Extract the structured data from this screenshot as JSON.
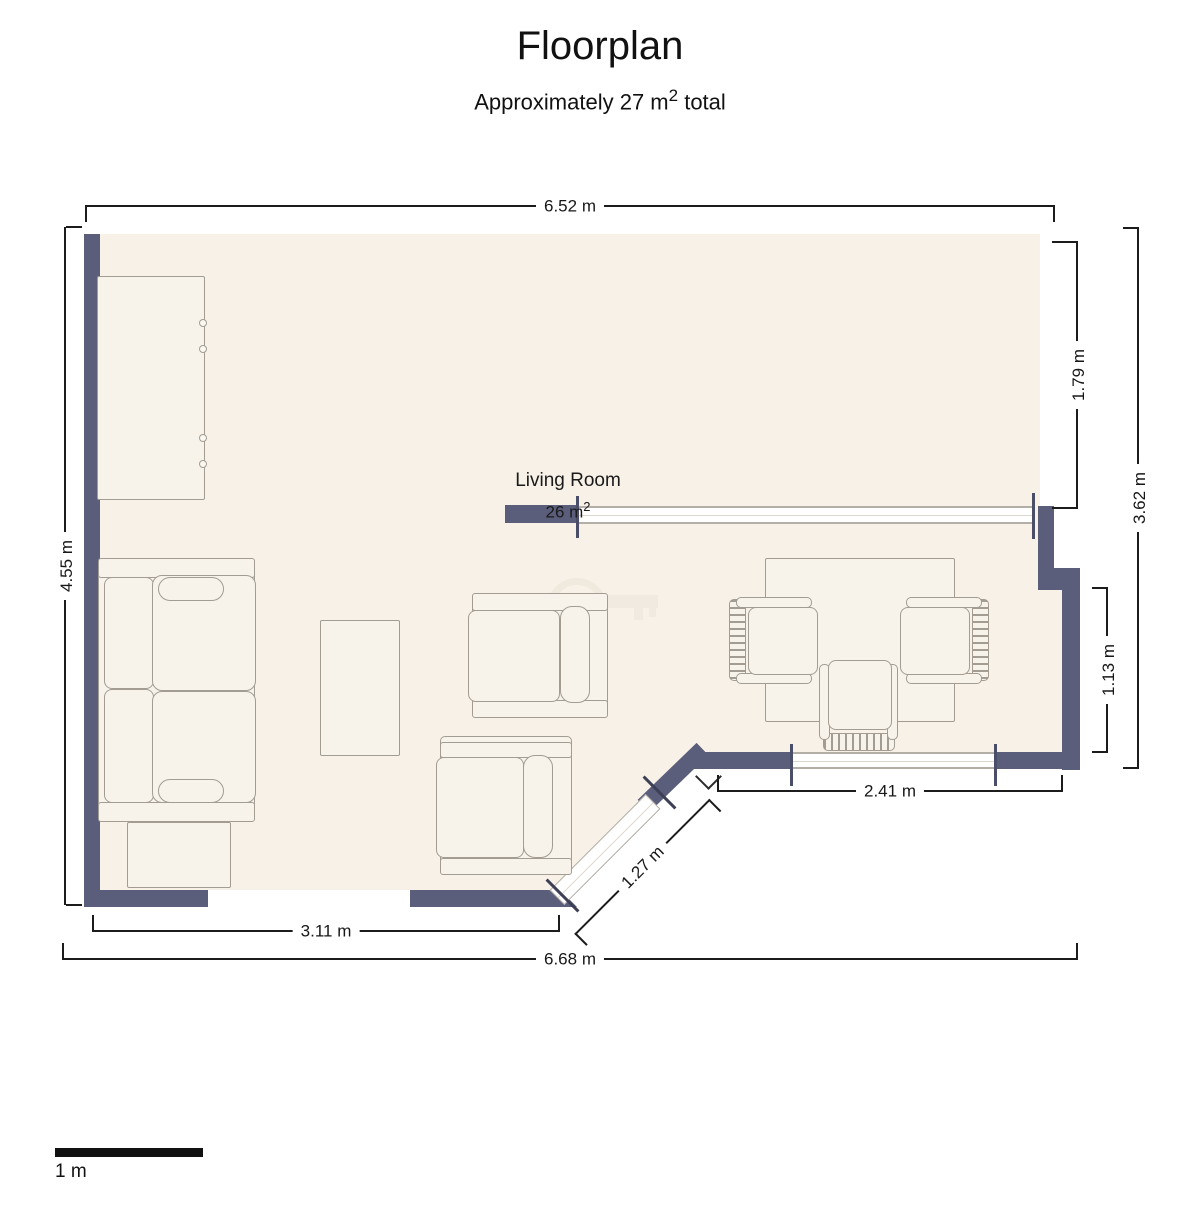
{
  "title": "Floorplan",
  "subtitle": {
    "prefix": "Approximately 27 m",
    "sup": "2",
    "suffix": " total"
  },
  "room": {
    "name": "Living Room",
    "area_prefix": "26 m",
    "area_sup": "2"
  },
  "dimensions": {
    "top_width": "6.52 m",
    "bottom_width": "6.68 m",
    "left_height": "4.55 m",
    "right_height": "3.62 m",
    "right_upper_segment": "1.79 m",
    "right_lower_segment": "1.13 m",
    "bottom_right_wall": "2.41 m",
    "bottom_left_wall": "3.11 m",
    "diagonal_door": "1.27 m"
  },
  "scale_bar": {
    "label": "1 m"
  },
  "colors": {
    "wall": "#5b5e7a",
    "floor": "#f8f1e8",
    "furniture_fill": "#f7f2ea",
    "furniture_outline": "#a29c93",
    "window": "#ffffff",
    "dimension": "#1c1c1c",
    "scale_bar": "#111111"
  },
  "furniture": [
    "cabinet",
    "sofa",
    "dresser",
    "coffee-table",
    "armchair",
    "armchair",
    "dining-table",
    "dining-chair",
    "dining-chair",
    "dining-chair"
  ]
}
